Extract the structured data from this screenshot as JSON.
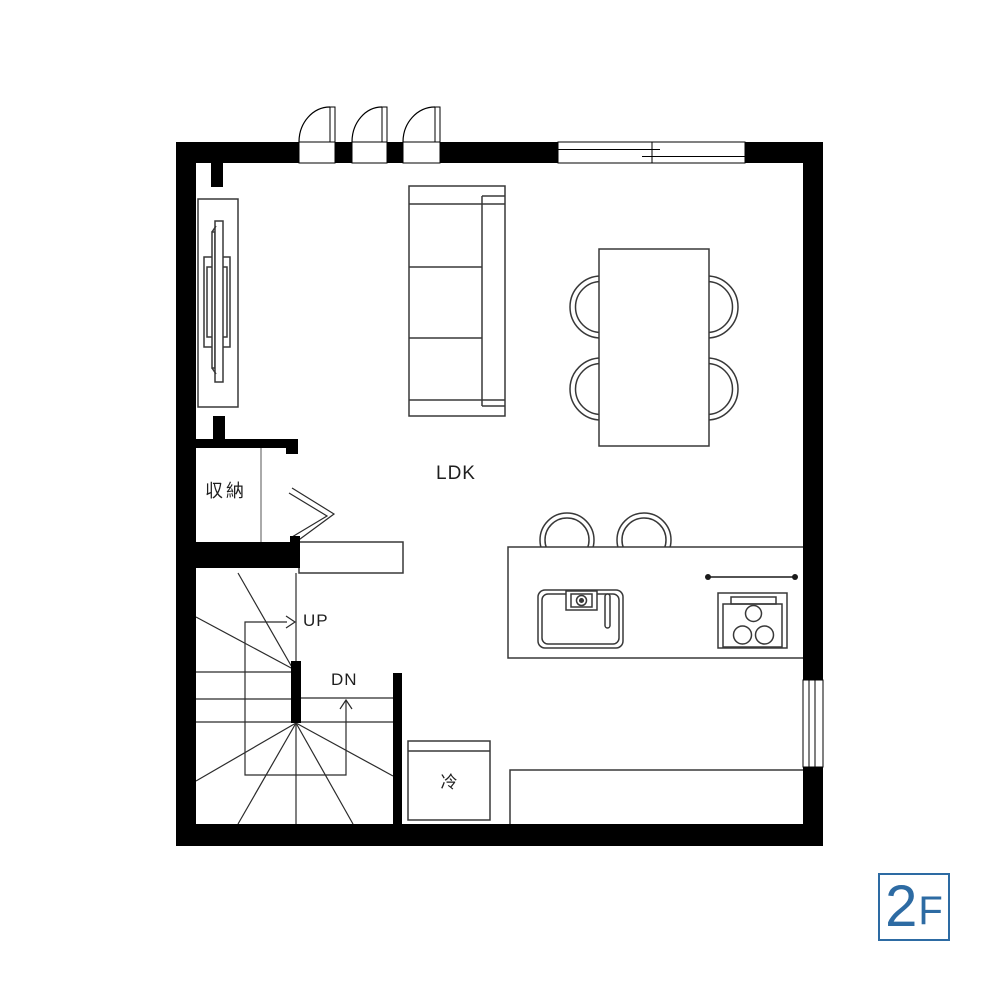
{
  "floorplan": {
    "floor_badge": {
      "number": "2",
      "suffix": "F"
    },
    "rooms": {
      "ldk_label": "LDK",
      "storage_label": "収納"
    },
    "fixtures": {
      "refrigerator_label": "冷",
      "stairs_up_label": "UP",
      "stairs_down_label": "DN"
    },
    "colors": {
      "wall": "#000000",
      "furniture_line": "#383838",
      "stair_line": "#2b2b2b",
      "accent_blue": "#2d6ba3",
      "background": "#ffffff",
      "text": "#1f1f1f"
    },
    "symbols": [
      "swing-door",
      "sliding-window",
      "tv-board",
      "sofa",
      "dining-table",
      "dining-chair",
      "counter-stool",
      "kitchen-island",
      "sink",
      "faucet",
      "cooktop",
      "refrigerator",
      "winder-staircase",
      "bifold-closet-door",
      "storage-room",
      "bottom-counter"
    ]
  }
}
